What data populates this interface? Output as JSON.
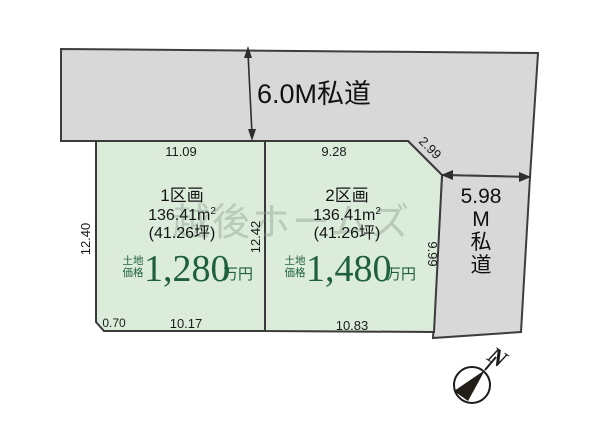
{
  "watermark": "越後ホームズ",
  "roads": {
    "top": {
      "label": "6.0M私道"
    },
    "right": {
      "line1": "5.98",
      "line2": "M",
      "line3": "私",
      "line4": "道"
    }
  },
  "dims": {
    "plot1_top": "11.09",
    "plot1_left": "12.40",
    "divider": "12.42",
    "plot1_bottom_left": "0.70",
    "plot1_bottom": "10.17",
    "plot2_top": "9.28",
    "plot2_diagonal": "2.99",
    "plot2_right": "9.99",
    "plot2_bottom": "10.83"
  },
  "plots": [
    {
      "name": "1区画",
      "area": "136.41m",
      "area_sup": "2",
      "tsubo": "(41.26坪)",
      "price_label_top": "土地",
      "price_label_bottom": "価格",
      "price": "1,280",
      "price_unit": "万円"
    },
    {
      "name": "2区画",
      "area": "136.41m",
      "area_sup": "2",
      "tsubo": "(41.26坪)",
      "price_label_top": "土地",
      "price_label_bottom": "価格",
      "price": "1,480",
      "price_unit": "万円"
    }
  ],
  "compass": {
    "north": "N"
  },
  "colors": {
    "road_fill": "#d8d8d8",
    "plot_fill": "#dcecdb",
    "outline": "#3d3d3d",
    "price_green": "#1e5f3e",
    "watermark_gray": "#8fa094"
  }
}
